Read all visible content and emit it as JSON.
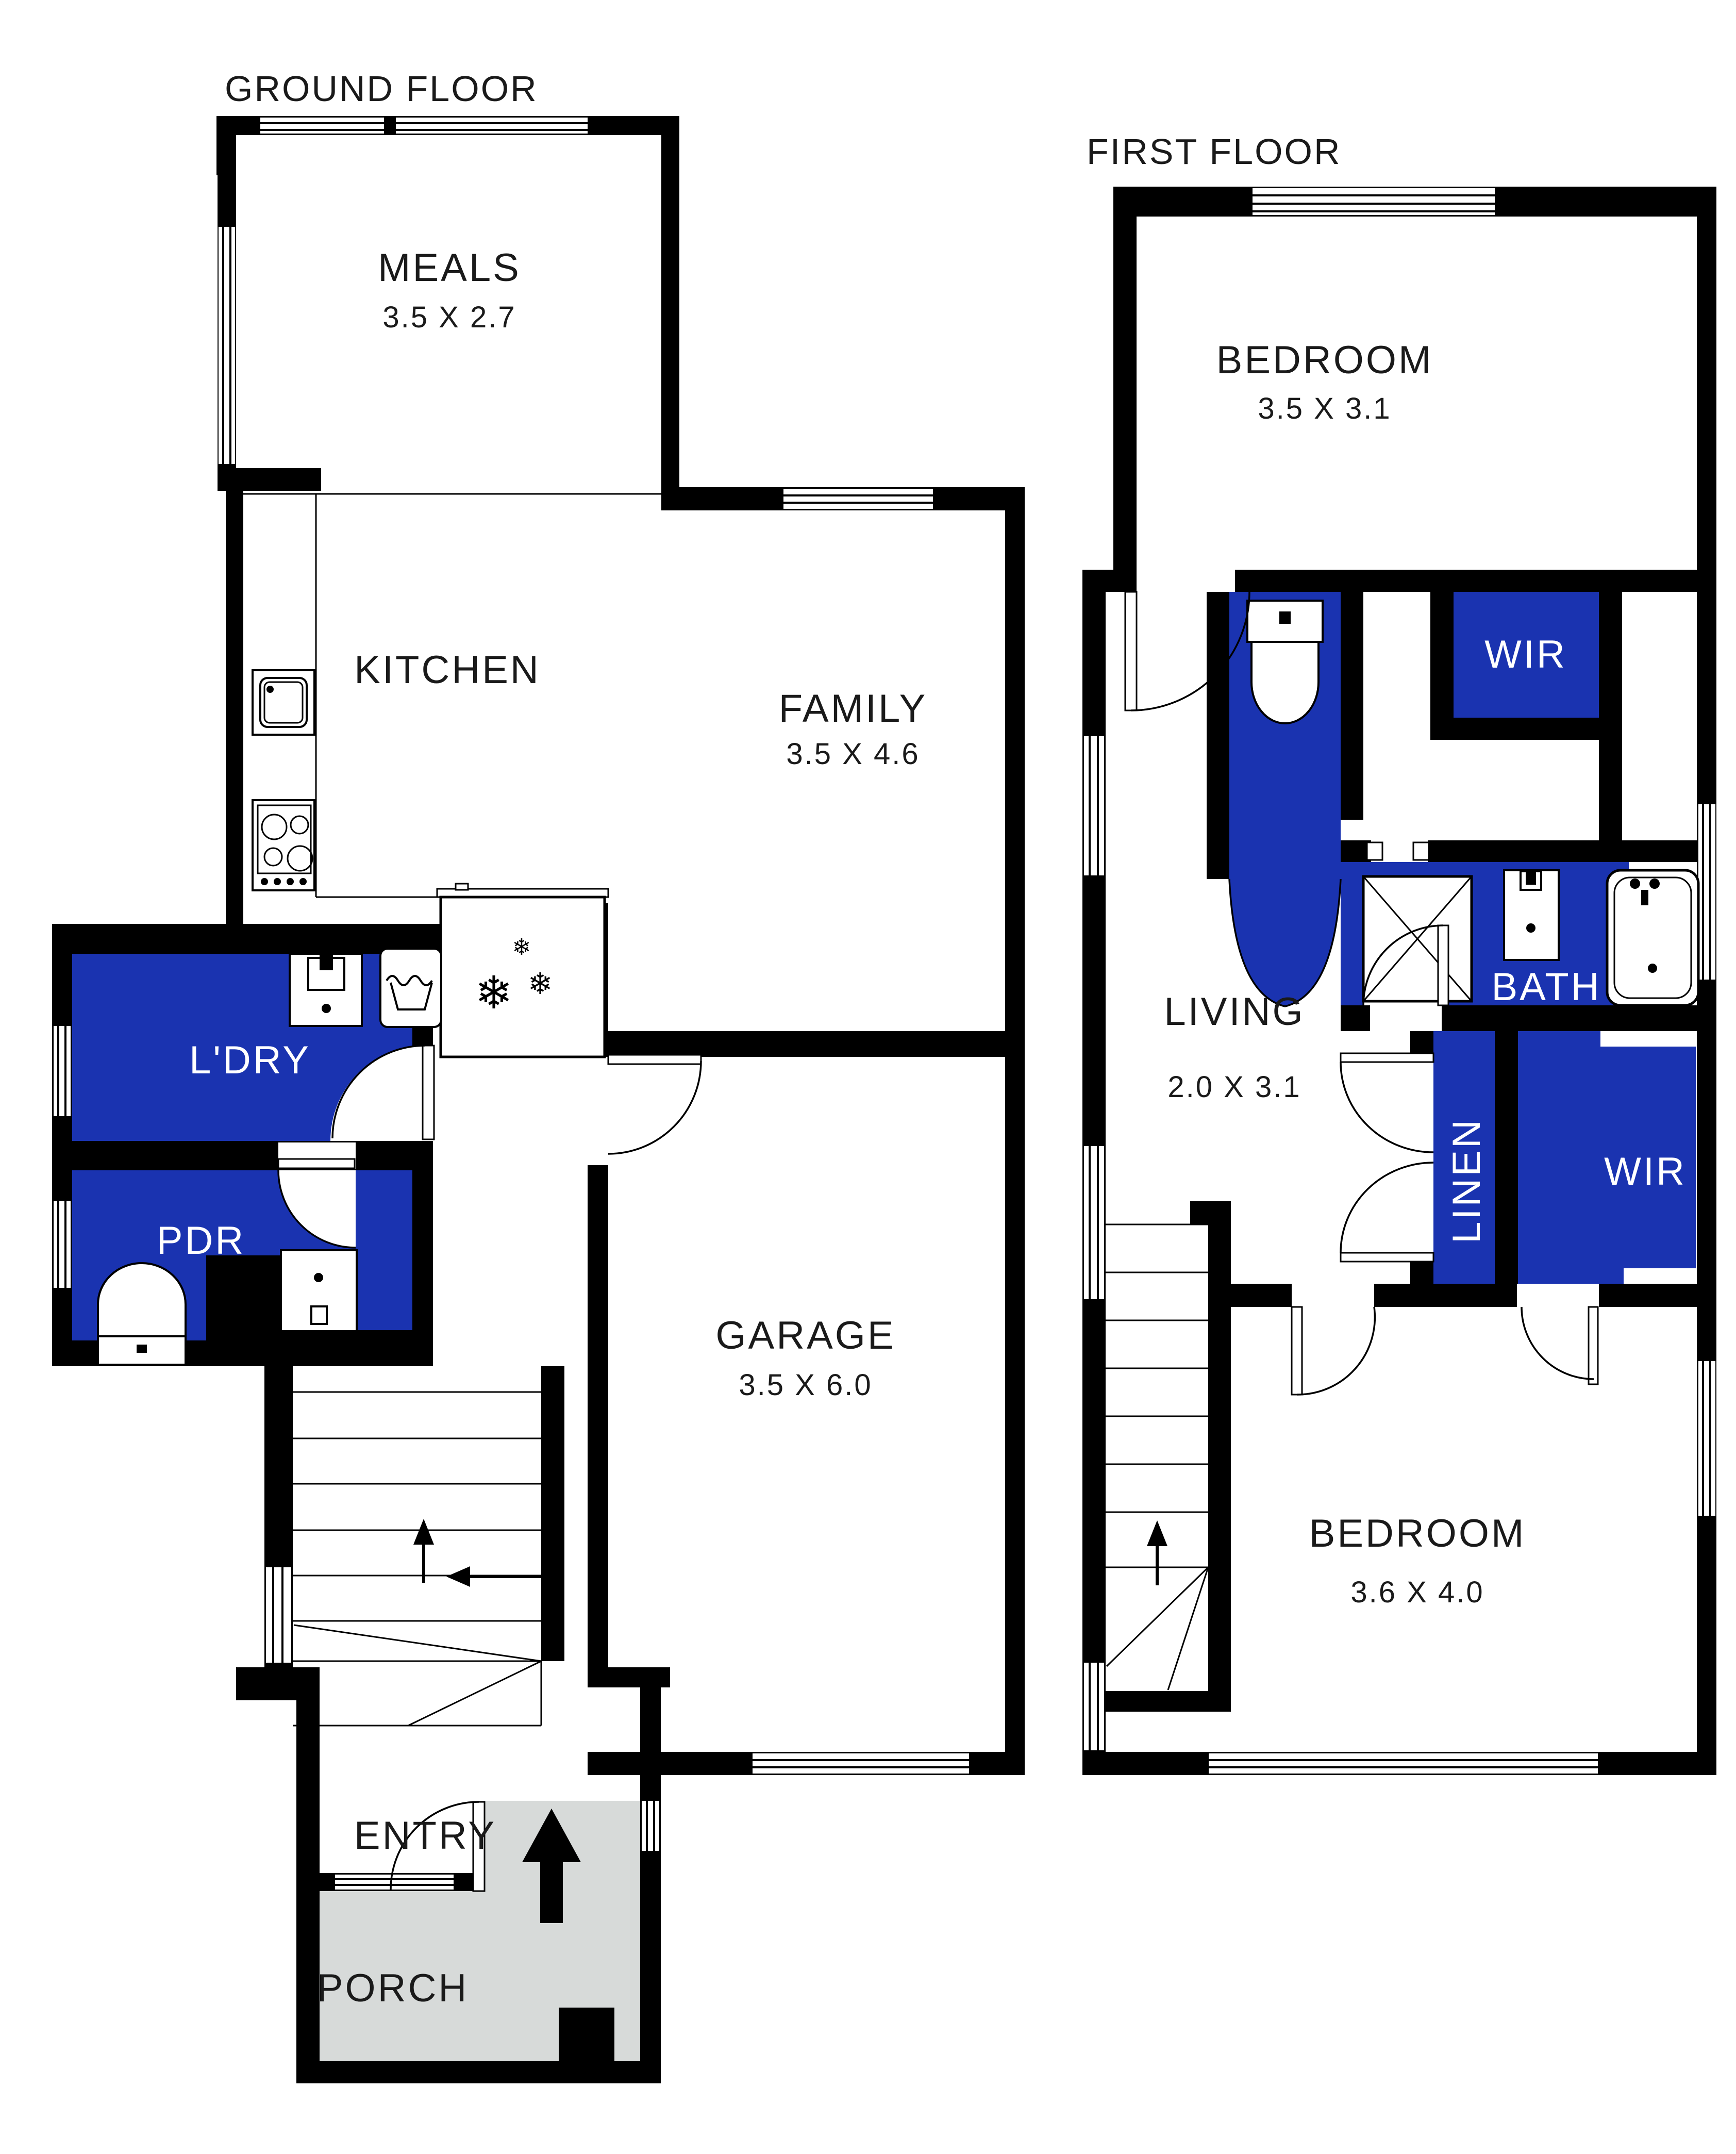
{
  "colors": {
    "room_fill": "#1A33B0",
    "porch_fill": "#D7DAD9",
    "wall": "#000000"
  },
  "icons": {
    "snowflake": "❄"
  },
  "ground_floor": {
    "title": "GROUND FLOOR",
    "rooms": {
      "meals": {
        "name": "MEALS",
        "dims": "3.5 X 2.7"
      },
      "kitchen": {
        "name": "KITCHEN"
      },
      "family": {
        "name": "FAMILY",
        "dims": "3.5 X 4.6"
      },
      "laundry": {
        "name": "L'DRY"
      },
      "powder": {
        "name": "PDR"
      },
      "garage": {
        "name": "GARAGE",
        "dims": "3.5 X 6.0"
      },
      "entry": {
        "name": "ENTRY"
      },
      "porch": {
        "name": "PORCH"
      }
    }
  },
  "first_floor": {
    "title": "FIRST FLOOR",
    "rooms": {
      "bedroom1": {
        "name": "BEDROOM",
        "dims": "3.5 X 3.1"
      },
      "wir1": {
        "name": "WIR"
      },
      "bath": {
        "name": "BATH"
      },
      "living": {
        "name": "LIVING",
        "dims": "2.0 X 3.1"
      },
      "linen": {
        "name": "LINEN"
      },
      "wir2": {
        "name": "WIR"
      },
      "bedroom2": {
        "name": "BEDROOM",
        "dims": "3.6 X 4.0"
      }
    }
  }
}
